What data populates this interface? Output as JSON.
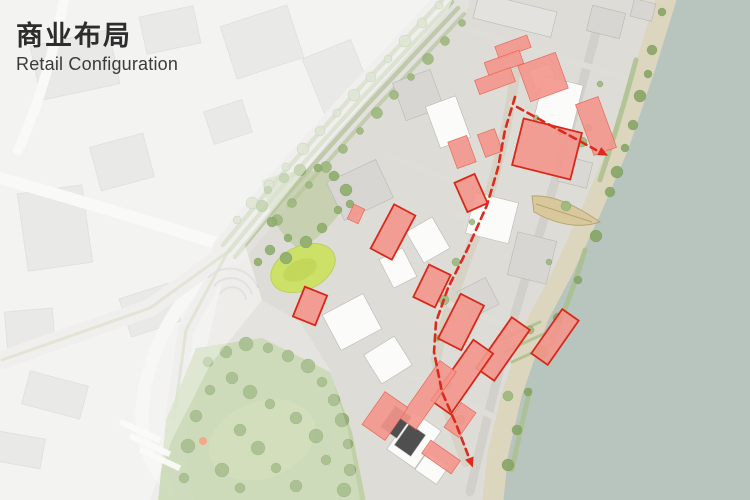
{
  "slide": {
    "title_cn": "商业布局",
    "title_en": "Retail Configuration"
  },
  "map": {
    "type": "masterplan-site-plan",
    "highlight_meaning": "retail buildings highlighted in red along a riverside pedestrian axis",
    "colors": {
      "retail_fill": "#f4968c",
      "retail_border": "#d8281a",
      "retail_soft_edge": "#e8685c",
      "path_red": "#dc2a1c",
      "water": "#b8c5be",
      "shore": "#ddd6bf",
      "ground": "#dedcd6",
      "road": "#e2e1de",
      "median_green": "#b6c49c",
      "tree_vivid": "#87a566",
      "tree_mid": "#9db87d",
      "tree_faded": "#c2cfad",
      "park_bright": "#cde168",
      "lawn": "#bccfa3",
      "building_white": "#fbfbfa",
      "building_gray": "#d7d6d2",
      "building_dark": "#4f4f4f",
      "context_building": "#d5d5d2",
      "fade": "#ffffff",
      "pier_tan": "#d9c89c",
      "poi_orange": "#f0926a"
    },
    "retail_buildings": [
      {
        "x": 513,
        "y": 47,
        "w": 34,
        "h": 13,
        "r": -20,
        "b": false
      },
      {
        "x": 504,
        "y": 63,
        "w": 37,
        "h": 14,
        "r": -20,
        "b": false
      },
      {
        "x": 495,
        "y": 81,
        "w": 38,
        "h": 15,
        "r": -20,
        "b": false
      },
      {
        "x": 543,
        "y": 77,
        "w": 40,
        "h": 38,
        "r": -20,
        "b": false
      },
      {
        "x": 596,
        "y": 126,
        "w": 24,
        "h": 54,
        "r": -20,
        "b": false
      },
      {
        "x": 547,
        "y": 149,
        "w": 60,
        "h": 48,
        "r": 14,
        "b": true
      },
      {
        "x": 462,
        "y": 152,
        "w": 20,
        "h": 28,
        "r": -20,
        "b": false
      },
      {
        "x": 490,
        "y": 143,
        "w": 18,
        "h": 24,
        "r": -20,
        "b": false
      },
      {
        "x": 471,
        "y": 193,
        "w": 22,
        "h": 32,
        "r": -24,
        "b": true
      },
      {
        "x": 393,
        "y": 232,
        "w": 24,
        "h": 50,
        "r": 28,
        "b": true
      },
      {
        "x": 432,
        "y": 286,
        "w": 24,
        "h": 36,
        "r": 26,
        "b": true
      },
      {
        "x": 461,
        "y": 322,
        "w": 26,
        "h": 50,
        "r": 27,
        "b": true
      },
      {
        "x": 310,
        "y": 306,
        "w": 24,
        "h": 32,
        "r": 22,
        "b": true
      },
      {
        "x": 555,
        "y": 337,
        "w": 20,
        "h": 54,
        "r": 35,
        "b": true
      },
      {
        "x": 503,
        "y": 349,
        "w": 22,
        "h": 62,
        "r": 35,
        "b": true
      },
      {
        "x": 462,
        "y": 377,
        "w": 24,
        "h": 74,
        "r": 35,
        "b": true
      },
      {
        "x": 428,
        "y": 395,
        "w": 20,
        "h": 70,
        "r": 35,
        "b": false
      },
      {
        "x": 385,
        "y": 416,
        "w": 28,
        "h": 40,
        "r": 35,
        "b": false
      },
      {
        "x": 441,
        "y": 457,
        "w": 36,
        "h": 16,
        "r": 35,
        "b": false
      },
      {
        "x": 460,
        "y": 420,
        "w": 18,
        "h": 30,
        "r": 35,
        "b": false
      },
      {
        "x": 356,
        "y": 214,
        "w": 12,
        "h": 16,
        "r": 25,
        "b": false
      }
    ],
    "pedestrian_axis": {
      "spine": [
        [
          515,
          97
        ],
        [
          505,
          130
        ],
        [
          498,
          168
        ],
        [
          487,
          205
        ],
        [
          468,
          248
        ],
        [
          448,
          288
        ],
        [
          436,
          322
        ],
        [
          434,
          352
        ],
        [
          442,
          392
        ],
        [
          456,
          424
        ],
        [
          468,
          455
        ]
      ],
      "branch": [
        [
          517,
          107
        ],
        [
          548,
          124
        ],
        [
          576,
          139
        ],
        [
          596,
          150
        ]
      ],
      "arrowheads": [
        {
          "x": 470,
          "y": 460,
          "angle": 69
        },
        {
          "x": 601,
          "y": 152,
          "angle": 27
        }
      ],
      "dash": [
        7,
        5
      ],
      "width": 2.6
    }
  }
}
